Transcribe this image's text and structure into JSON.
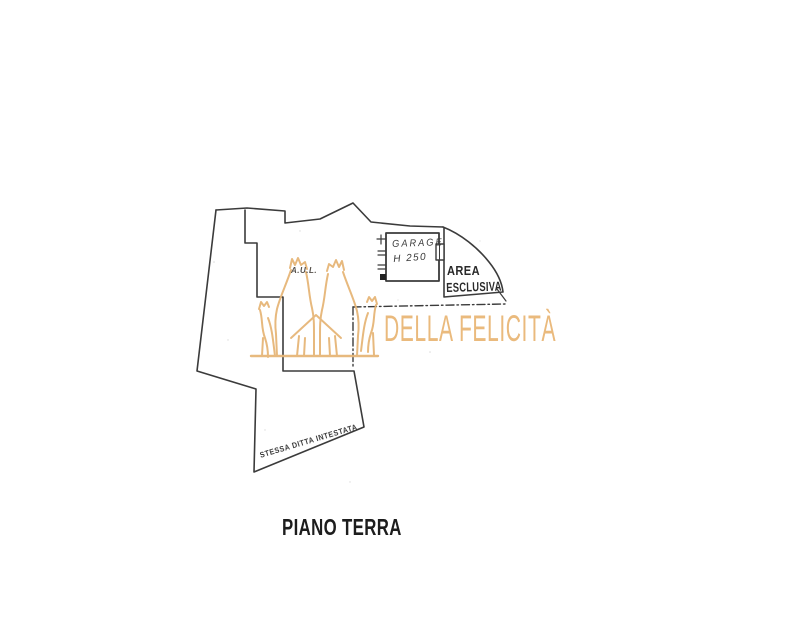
{
  "page": {
    "background": "#ffffff"
  },
  "plan": {
    "line_color": "#3b3b3b",
    "labels": {
      "garage": "GARAGE",
      "garage_height": "H 250",
      "area_line1": "AREA",
      "area_line2": "ESCLUSIVA",
      "annex": "A.U.L.",
      "boundary_note": "STESSA DITTA INTESTATA",
      "floor_title": "PIANO TERRA"
    }
  },
  "watermark": {
    "agency": "DELLA FELICITÀ",
    "color": "#e6b678"
  }
}
